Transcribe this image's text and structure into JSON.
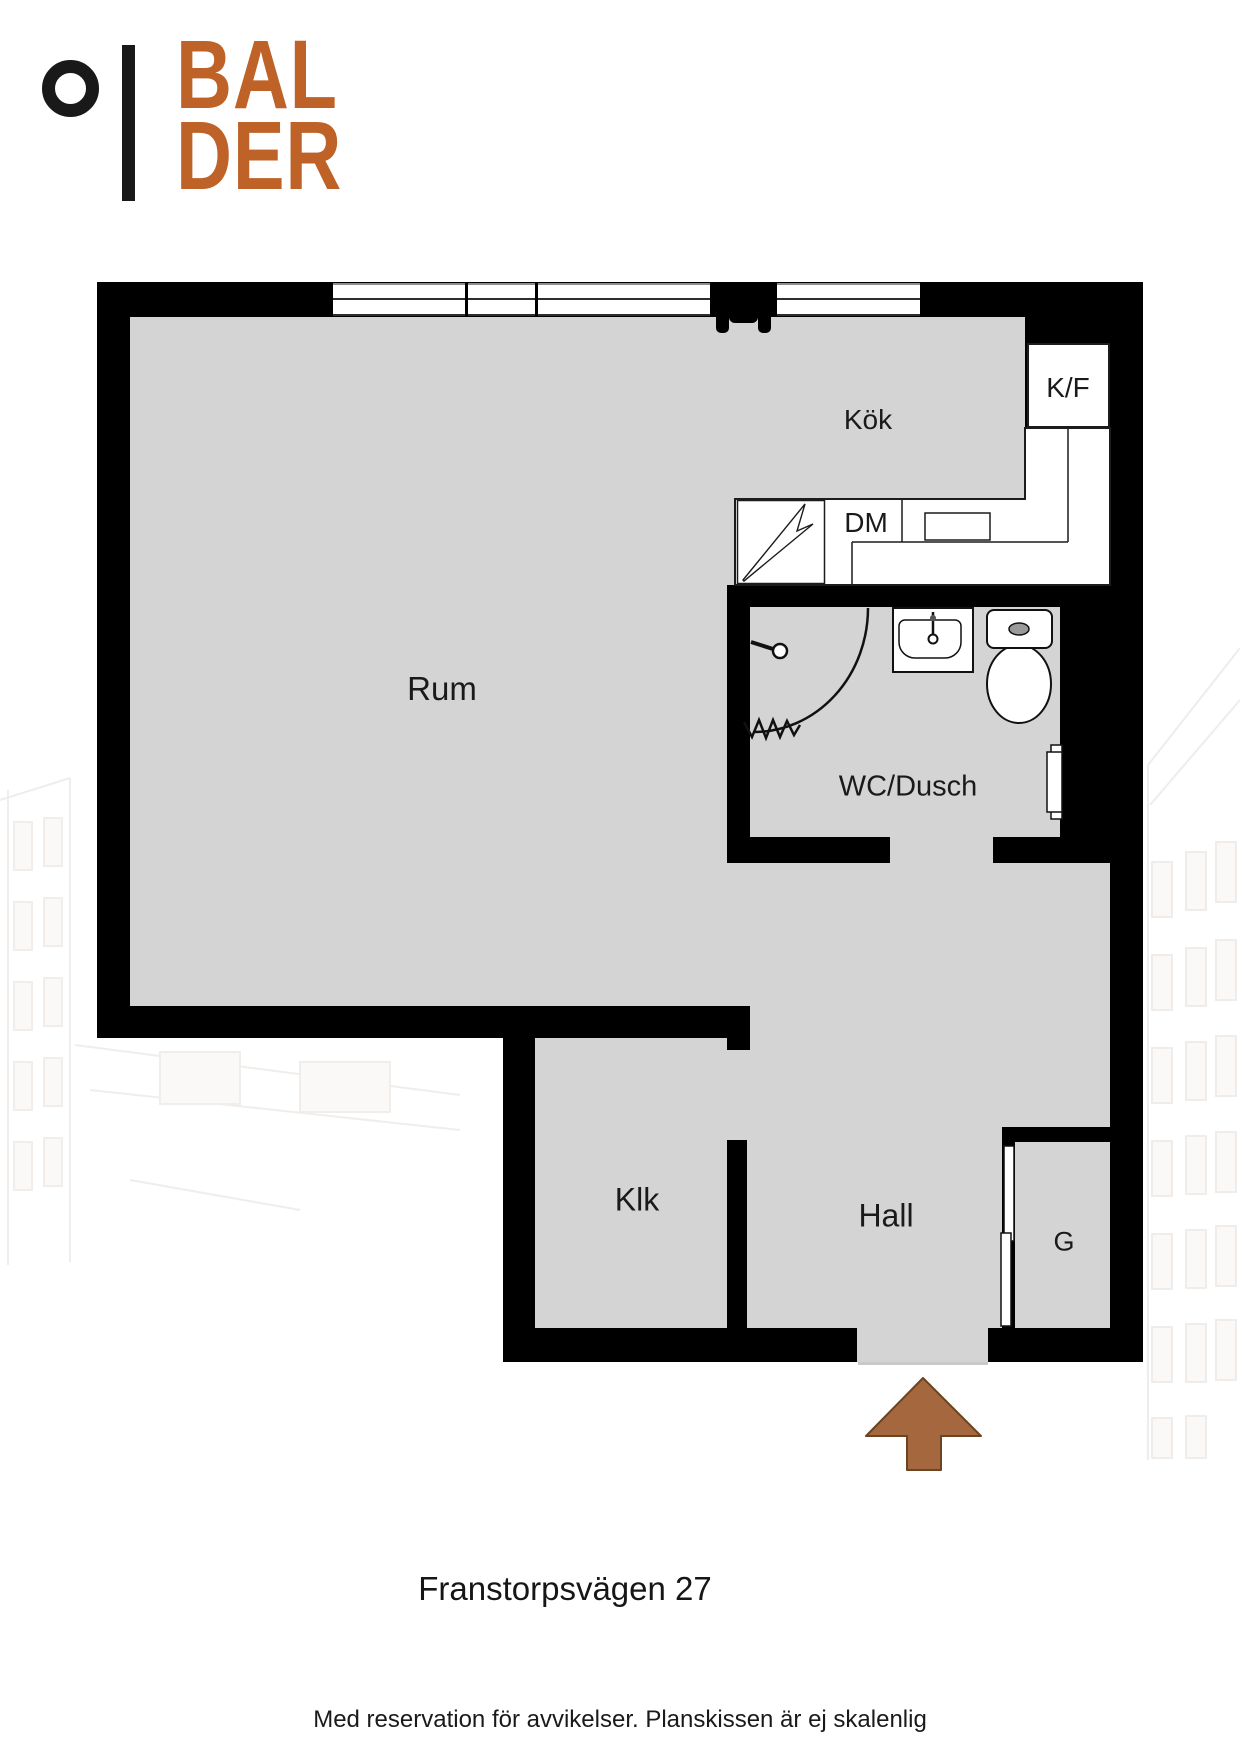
{
  "logo": {
    "line1": "BAL",
    "line2": "DER",
    "mark": "ring-and-bar-icon"
  },
  "labels": {
    "rum": "Rum",
    "kok": "Kök",
    "kf": "K/F",
    "dm": "DM",
    "wc_dusch": "WC/Dusch",
    "klk": "Klk",
    "hall": "Hall",
    "g": "G"
  },
  "address": {
    "title": "Franstorpsvägen 27"
  },
  "footer": {
    "disclaimer": "Med reservation för avvikelser. Planskissen är ej skalenlig"
  },
  "colors": {
    "wall": "#000000",
    "floor": "#d4d4d4",
    "logo_orange": "#bf6227",
    "arrow_brown": "#a5673d",
    "text": "#1a1a1a",
    "window_line": "#8d8d8d"
  },
  "icons": {
    "entrance_arrow": "up-arrow-icon",
    "stove": "lightning-bolt-icon",
    "shower": "shower-corner-icon",
    "sink": "washbasin-icon",
    "toilet": "toilet-icon",
    "radiator": "radiator-icon",
    "wardrobe_doors": "sliding-doors-icon"
  }
}
